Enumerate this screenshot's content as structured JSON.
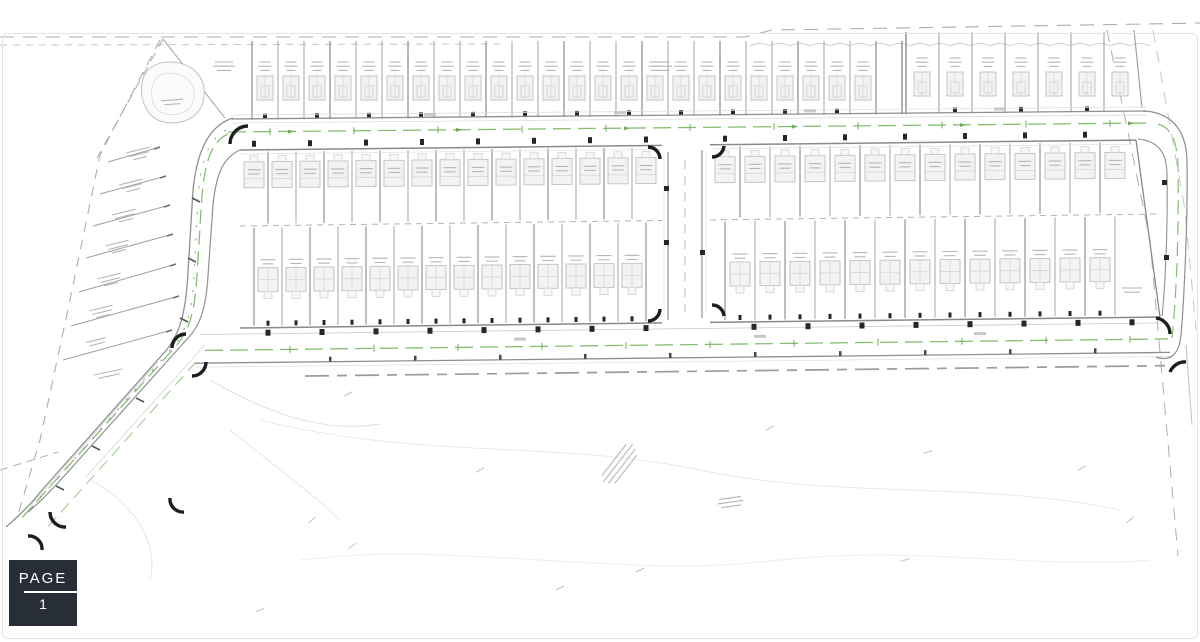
{
  "page_badge": {
    "label": "PAGE",
    "number": "1"
  },
  "palette": {
    "border": "#e4e4e6",
    "badge_bg": "#272e38",
    "badge_text": "#ffffff",
    "boundary": "#adadad",
    "boundary_faint": "#c6c6c6",
    "road_edge": "#8f8f8f",
    "road_edge_light": "#dcdcdc",
    "lot_line": "#9a9a9a",
    "lot_line_dark": "#7d7d7d",
    "house_fill": "#f3f3f3",
    "house_stroke": "#c0c0c0",
    "house_inner": "#d2d2d2",
    "smudge": "#b5b5b5",
    "green": "#84bf6f",
    "green_dark": "#6fae5a",
    "black_mark": "#262626",
    "faint": "#dedede",
    "contour": "#e6e6e6",
    "scatter": "#cdcdcd"
  },
  "plan": {
    "top_row": {
      "left_count": 25,
      "left_start": 252,
      "left_step": 26,
      "right_count": 6,
      "right_start": 906,
      "right_step": 33
    },
    "mid_left": {
      "upper_count": 14,
      "upper_start": 268,
      "lower_count": 15,
      "lower_start": 254,
      "step": 28,
      "x0": 240,
      "x1": 662
    },
    "mid_right": {
      "upper_count": 13,
      "upper_start": 740,
      "lower_count": 14,
      "lower_start": 725,
      "step": 30,
      "x0": 710,
      "x1": 1160
    }
  }
}
